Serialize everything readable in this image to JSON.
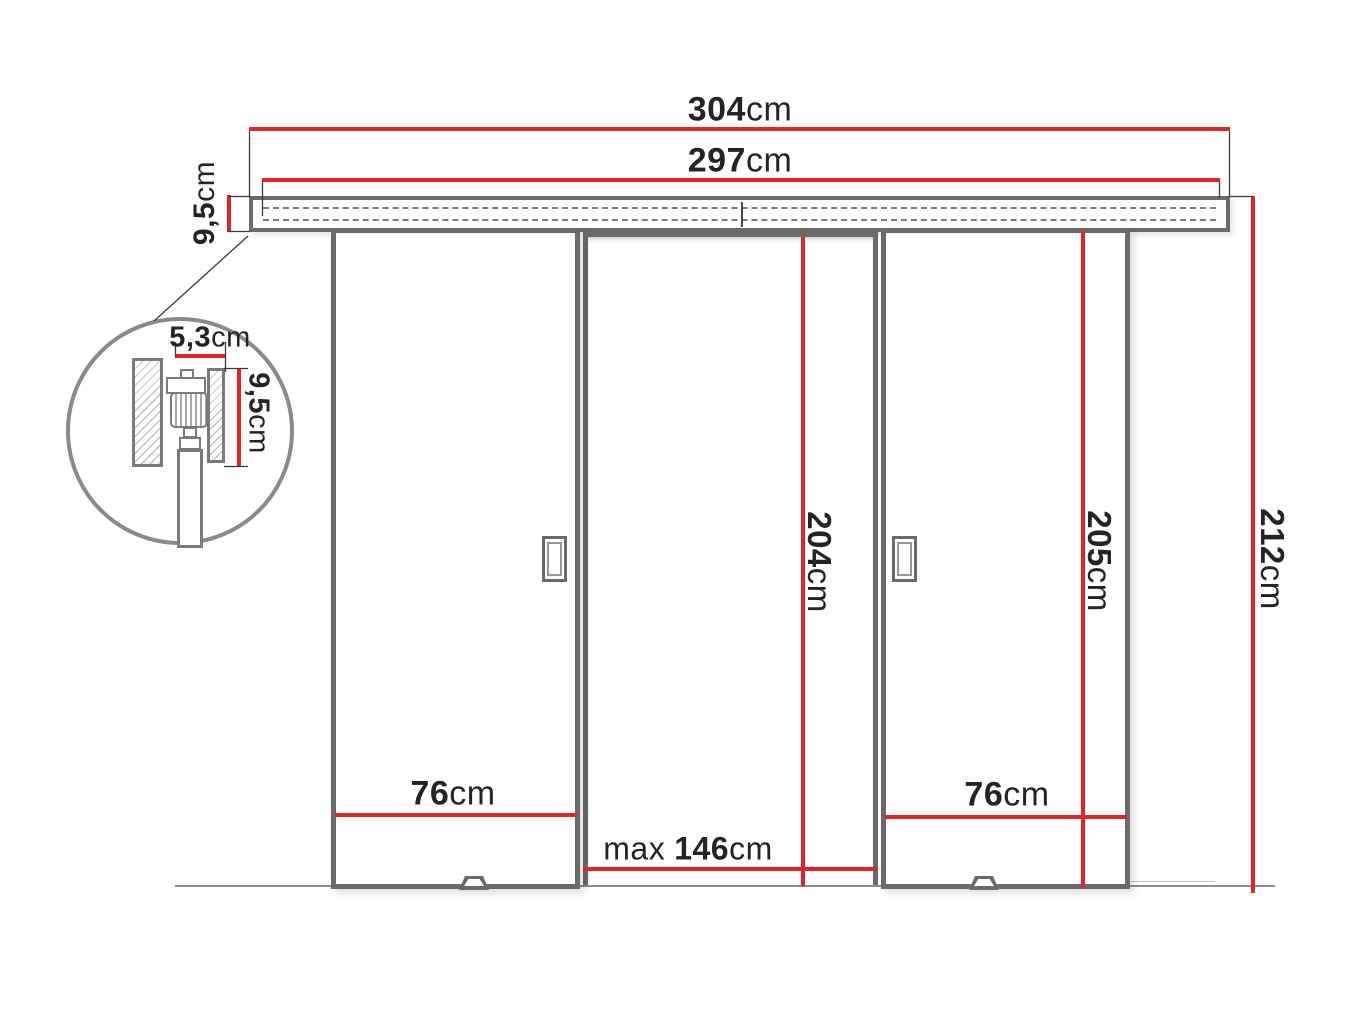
{
  "diagram": {
    "type": "technical-drawing",
    "subject": "double-sliding-door-system-dimensions",
    "colors": {
      "dimension_line": "#e42329",
      "outline": "#6a6a6a",
      "text": "#272324"
    },
    "dimensions": {
      "total_width": {
        "value": "304",
        "unit": "cm"
      },
      "track_width": {
        "value": "297",
        "unit": "cm"
      },
      "track_height": {
        "value": "9,5",
        "unit": "cm"
      },
      "detail_track_width": {
        "value": "5,3",
        "unit": "cm"
      },
      "detail_track_height": {
        "value": "9,5",
        "unit": "cm"
      },
      "opening_height": {
        "value": "204",
        "unit": "cm"
      },
      "door_height": {
        "value": "205",
        "unit": "cm"
      },
      "total_height": {
        "value": "212",
        "unit": "cm"
      },
      "left_door_width": {
        "value": "76",
        "unit": "cm"
      },
      "right_door_width": {
        "value": "76",
        "unit": "cm"
      },
      "max_passage_width": {
        "prefix": "max",
        "value": "146",
        "unit": "cm"
      }
    }
  }
}
